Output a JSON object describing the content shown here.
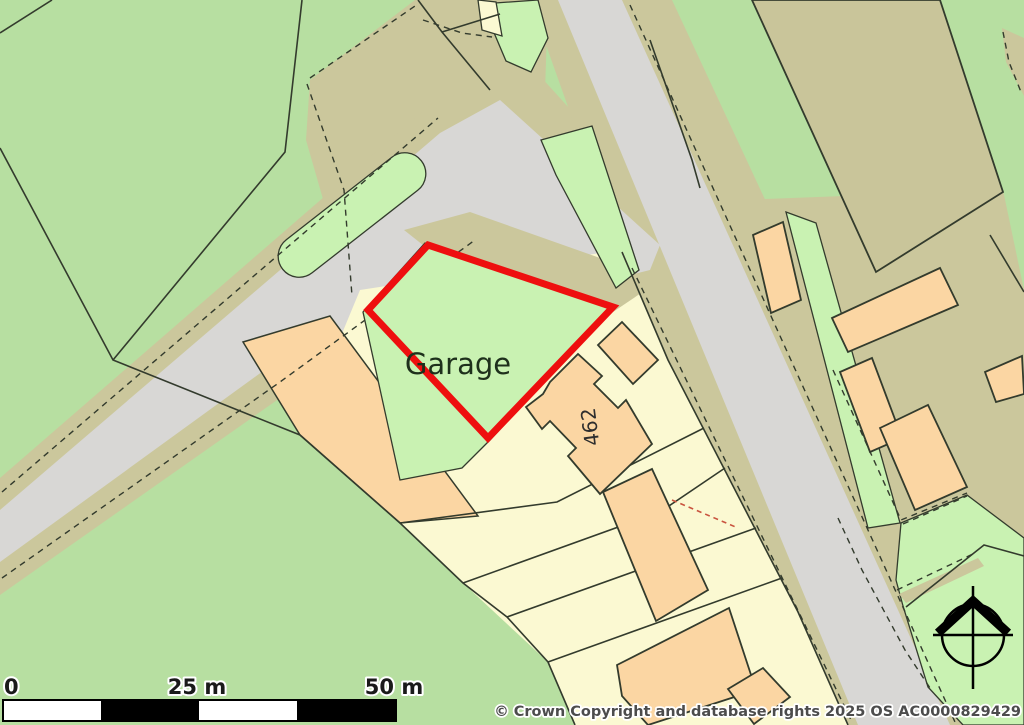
{
  "map": {
    "plot_label": "Garage",
    "house_number": "462",
    "highlight_color": "#ee0f0f"
  },
  "scale_bar": {
    "ticks": [
      "0",
      "25 m",
      "50 m"
    ]
  },
  "attribution": "© Crown Copyright and database rights 2025 OS AC0000829429",
  "colors": {
    "field_green": "#b7dfa1",
    "plot_green": "#c9f2b2",
    "road_gray": "#d8d7d5",
    "verge_khaki": "#cbc79c",
    "plot_yellow": "#fbf9d2",
    "building_peach": "#fbd6a3",
    "boundary_red": "#ee0f0f",
    "line_dark": "#333b2d"
  }
}
